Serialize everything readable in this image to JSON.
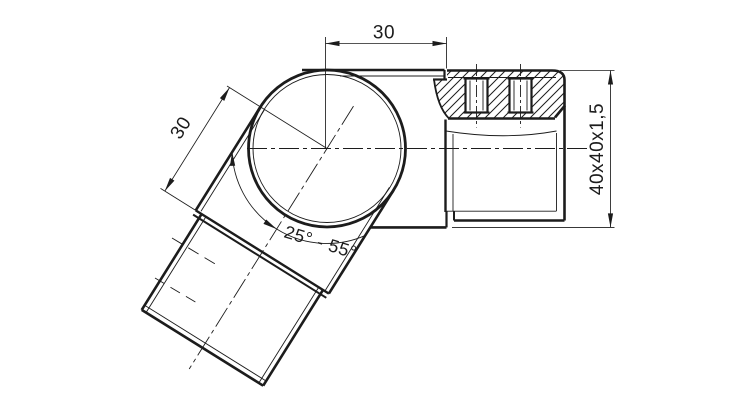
{
  "drawing": {
    "dimension_labels": {
      "top_offset": "30",
      "side_offset": "30",
      "angle_range": "25° - 55°",
      "profile_size": "40x40x1,5"
    },
    "colors": {
      "line": "#1c1c1c",
      "background": "#ffffff"
    }
  }
}
